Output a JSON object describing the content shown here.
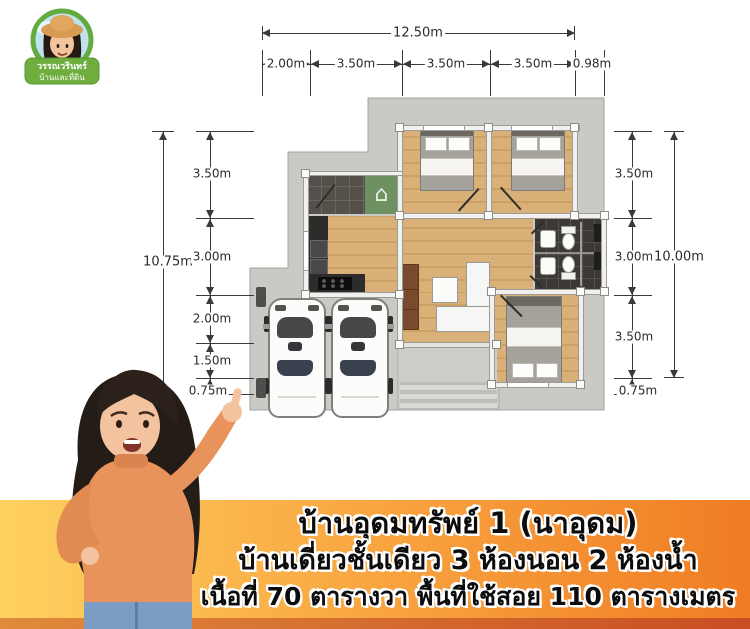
{
  "logo": {
    "brand_line1": "วรรณวรินทร์",
    "brand_line2": "บ้านและที่ดิน"
  },
  "plan": {
    "dims": {
      "top_total": "12.50m",
      "top_segments": [
        "2.00m",
        "3.50m",
        "3.50m",
        "3.50m",
        "0.98m"
      ],
      "left_total": "10.75m",
      "left_segments": [
        "3.50m",
        "3.00m",
        "2.00m",
        "1.50m",
        "0.75m"
      ],
      "right_total": "10.00m",
      "right_segments": [
        "3.50m",
        "3.00m",
        "3.50m",
        "0.75m"
      ]
    },
    "icons": {
      "house_glyph": "⌂"
    }
  },
  "banner": {
    "line1": "บ้านอุดมทรัพย์ 1 (นาอุดม)",
    "line2": "บ้านเดี่ยวชั้นเดียว 3 ห้องนอน 2 ห้องน้ำ",
    "line3": "เนื้อที่ 70 ตารางวา พื้นที่ใช้สอย 110 ตารางเมตร",
    "colors": {
      "gradient_left": "#fdd160",
      "gradient_right": "#f07c24",
      "bottom_strip": "#c94e22",
      "text": "#0c0c0c",
      "text_outline": "#ffffff"
    }
  }
}
